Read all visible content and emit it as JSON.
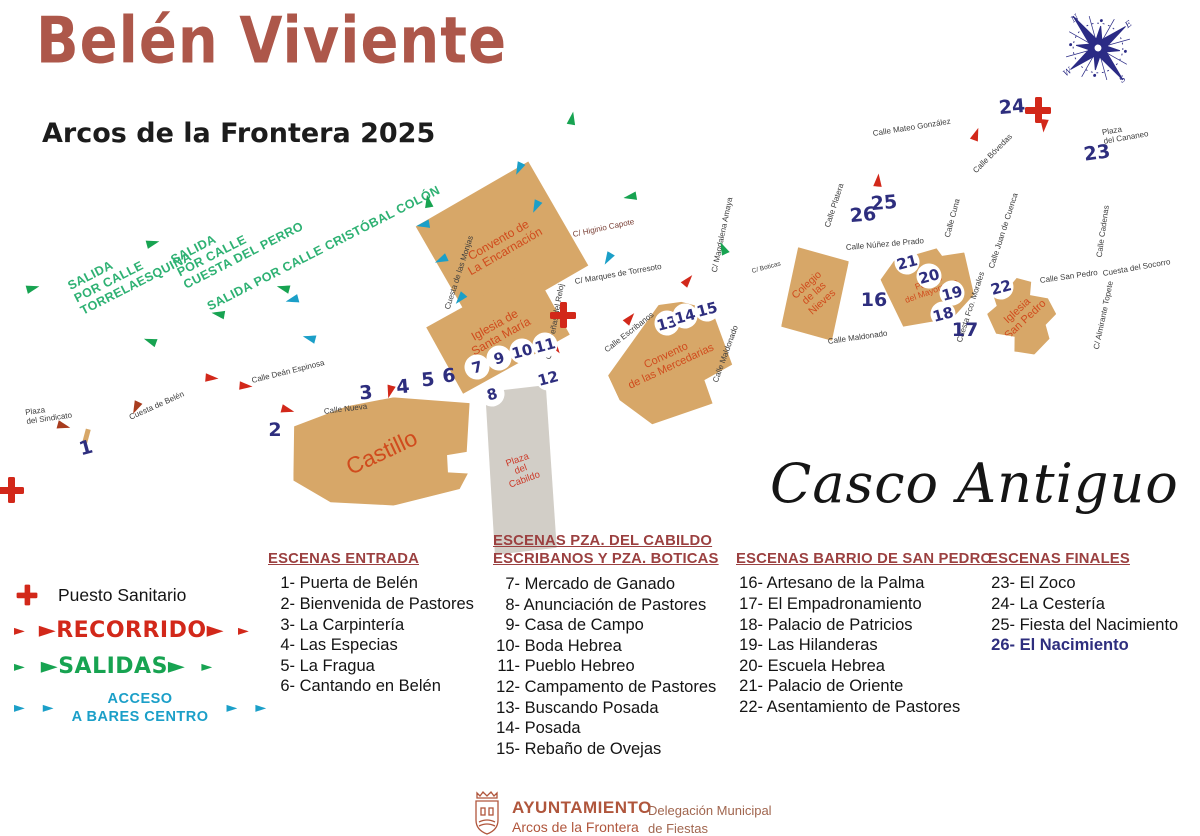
{
  "header": {
    "title": "Belén Viviente",
    "subtitle": "Arcos de la Frontera 2025"
  },
  "casco_antiguo": "Casco Antiguo",
  "compass": {
    "n": "N",
    "e": "E",
    "s": "S",
    "w": "W"
  },
  "colors": {
    "accent_red": "#d2281a",
    "dark_red": "#a83c1e",
    "green": "#17a351",
    "teal": "#1b9fc8",
    "navy": "#2e2e7e",
    "building": "#d7a768",
    "building_label": "#d04b1d",
    "plaza_gray": "#d2cec7",
    "header_maroon": "#9b4040",
    "title_brick": "#ad574a",
    "salida_green": "#2eb173",
    "footer_brick": "#b0563c"
  },
  "map": {
    "arrow_glyph": "►",
    "buildings": [
      {
        "id": "encarnacion",
        "label": [
          "Convento de",
          "La Encarnación"
        ],
        "x": 437,
        "y": 186,
        "w": 130,
        "h": 120,
        "rot": -30,
        "label_rot": 0,
        "fs": 12
      },
      {
        "id": "santa-maria",
        "label": [
          "Iglesia de",
          "Santa María"
        ],
        "x": 437,
        "y": 293,
        "w": 122,
        "h": 76,
        "rot": -29,
        "label_rot": 0,
        "fs": 12
      },
      {
        "id": "castillo",
        "label": [
          "Castillo"
        ],
        "x": 292,
        "y": 398,
        "w": 180,
        "h": 108,
        "rot": -3,
        "label_rot": -22,
        "fs": 23
      },
      {
        "id": "cabildo",
        "label": [
          "Plaza",
          "del",
          "Cabildo"
        ],
        "x": 488,
        "y": 386,
        "w": 66,
        "h": 168,
        "rot": -2,
        "label_rot": -18,
        "fs": 9.5,
        "fill": "#d2cec7",
        "lc": "#cc3b2a"
      },
      {
        "id": "mercedarias",
        "label": [
          "Convento",
          "de las Mercedarias"
        ],
        "x": 608,
        "y": 306,
        "w": 122,
        "h": 112,
        "rot": -25,
        "label_rot": 0,
        "fs": 11
      },
      {
        "id": "nieves",
        "label": [
          "Colegio",
          "de las",
          "Nieves"
        ],
        "x": 786,
        "y": 250,
        "w": 58,
        "h": 88,
        "rot": 8,
        "label_rot": -50,
        "fs": 10.5
      },
      {
        "id": "mayorazgo",
        "label": [
          "Palacio",
          "del Mayorazgo"
        ],
        "x": 886,
        "y": 250,
        "w": 88,
        "h": 74,
        "rot": -20,
        "label_rot": 0,
        "fs": 8.5
      },
      {
        "id": "san-pedro",
        "label": [
          "Iglesia",
          "San Pedro"
        ],
        "x": 988,
        "y": 276,
        "w": 68,
        "h": 80,
        "rot": -10,
        "label_rot": -33,
        "fs": 11
      },
      {
        "id": "gate",
        "label": [],
        "x": 84,
        "y": 429,
        "w": 5,
        "h": 14,
        "rot": 15
      }
    ],
    "streets": [
      {
        "t": [
          "Cuesta de las Monjas"
        ],
        "x": 448,
        "y": 305,
        "rot": -72
      },
      {
        "t": [
          "C/ Higinio Capote"
        ],
        "x": 573,
        "y": 231,
        "rot": -12,
        "c": "#7a4036"
      },
      {
        "t": [
          "C/ Marques de Torresoto"
        ],
        "x": 575,
        "y": 278,
        "rot": -10
      },
      {
        "t": [
          "Calle Deán Espinosa"
        ],
        "x": 252,
        "y": 377,
        "rot": -14
      },
      {
        "t": [
          "Cuesta de Belén"
        ],
        "x": 130,
        "y": 414,
        "rot": -24
      },
      {
        "t": [
          "Plaza",
          "del Sindicato"
        ],
        "x": 26,
        "y": 409,
        "rot": -8
      },
      {
        "t": [
          "Calle Nueva"
        ],
        "x": 324,
        "y": 408,
        "rot": -7
      },
      {
        "t": [
          "Calle Peñas del Reloj"
        ],
        "x": 549,
        "y": 355,
        "rot": -80
      },
      {
        "t": [
          "Calle Escribanos"
        ],
        "x": 606,
        "y": 347,
        "rot": -38
      },
      {
        "t": [
          "Calle Maldonado"
        ],
        "x": 716,
        "y": 378,
        "rot": -70
      },
      {
        "t": [
          "Calle Maldonado"
        ],
        "x": 828,
        "y": 338,
        "rot": -8
      },
      {
        "t": [
          "C/ Magdalena Amaya"
        ],
        "x": 715,
        "y": 268,
        "rot": -78
      },
      {
        "t": [
          "C/ Boticas"
        ],
        "x": 752,
        "y": 268,
        "rot": -15,
        "fs": 6.5
      },
      {
        "t": [
          "Calle Platera"
        ],
        "x": 828,
        "y": 223,
        "rot": -72
      },
      {
        "t": [
          "Calle Núñez de Prado"
        ],
        "x": 846,
        "y": 244,
        "rot": -5
      },
      {
        "t": [
          "Calle Cuna"
        ],
        "x": 948,
        "y": 233,
        "rot": -75
      },
      {
        "t": [
          "Calle Juan de Cuenca"
        ],
        "x": 992,
        "y": 264,
        "rot": -72
      },
      {
        "t": [
          "Calle Mateo González"
        ],
        "x": 873,
        "y": 130,
        "rot": -9
      },
      {
        "t": [
          "Calle Bóvedas"
        ],
        "x": 975,
        "y": 168,
        "rot": -45
      },
      {
        "t": [
          "Plaza",
          "del Cananeo"
        ],
        "x": 1103,
        "y": 129,
        "rot": -10
      },
      {
        "t": [
          "Calle San Pedro"
        ],
        "x": 1040,
        "y": 277,
        "rot": -8
      },
      {
        "t": [
          "Cuesta del Socorro"
        ],
        "x": 1103,
        "y": 270,
        "rot": -10
      },
      {
        "t": [
          "C/ Almirante Topete"
        ],
        "x": 1097,
        "y": 345,
        "rot": -78
      },
      {
        "t": [
          "Calle Cadenas"
        ],
        "x": 1100,
        "y": 253,
        "rot": -82
      },
      {
        "t": [
          "Cuesta Fco. Morales"
        ],
        "x": 960,
        "y": 338,
        "rot": -72
      }
    ],
    "markers": [
      {
        "n": "1",
        "x": 86,
        "y": 448,
        "rot": -15
      },
      {
        "n": "2",
        "x": 275,
        "y": 430
      },
      {
        "n": "3",
        "x": 366,
        "y": 393,
        "rot": -5
      },
      {
        "n": "4",
        "x": 403,
        "y": 387,
        "rot": -5
      },
      {
        "n": "5",
        "x": 428,
        "y": 380,
        "rot": -5
      },
      {
        "n": "6",
        "x": 449,
        "y": 376,
        "rot": -5
      },
      {
        "n": "7",
        "x": 477,
        "y": 367,
        "circ": true
      },
      {
        "n": "8",
        "x": 492,
        "y": 394,
        "circ": true
      },
      {
        "n": "9",
        "x": 499,
        "y": 358,
        "circ": true
      },
      {
        "n": "10",
        "x": 522,
        "y": 351,
        "circ": true
      },
      {
        "n": "11",
        "x": 545,
        "y": 345,
        "circ": true
      },
      {
        "n": "12",
        "x": 548,
        "y": 378,
        "circ": true
      },
      {
        "n": "13",
        "x": 667,
        "y": 323,
        "circ": true
      },
      {
        "n": "14",
        "x": 685,
        "y": 316,
        "circ": true
      },
      {
        "n": "15",
        "x": 707,
        "y": 309,
        "circ": true
      },
      {
        "n": "16",
        "x": 874,
        "y": 300
      },
      {
        "n": "17",
        "x": 965,
        "y": 330
      },
      {
        "n": "18",
        "x": 943,
        "y": 314,
        "circ": true
      },
      {
        "n": "19",
        "x": 952,
        "y": 293,
        "circ": true
      },
      {
        "n": "20",
        "x": 929,
        "y": 276,
        "circ": true
      },
      {
        "n": "21",
        "x": 907,
        "y": 262,
        "circ": true
      },
      {
        "n": "22",
        "x": 1001,
        "y": 287,
        "circ": true
      },
      {
        "n": "23",
        "x": 1097,
        "y": 153,
        "rot": -8
      },
      {
        "n": "24",
        "x": 1012,
        "y": 107,
        "rot": -5
      },
      {
        "n": "25",
        "x": 884,
        "y": 203,
        "rot": -5
      },
      {
        "n": "26",
        "x": 863,
        "y": 215,
        "rot": -5
      }
    ],
    "arrows": [
      {
        "x": 212,
        "y": 378,
        "rot": 5,
        "c": "accent_red"
      },
      {
        "x": 246,
        "y": 386,
        "rot": 5,
        "c": "accent_red"
      },
      {
        "x": 136,
        "y": 408,
        "rot": 115,
        "c": "dark_red"
      },
      {
        "x": 288,
        "y": 410,
        "rot": 15,
        "c": "accent_red"
      },
      {
        "x": 64,
        "y": 426,
        "rot": 15,
        "c": "dark_red"
      },
      {
        "x": 390,
        "y": 392,
        "rot": 105,
        "c": "accent_red"
      },
      {
        "x": 556,
        "y": 348,
        "rot": 55,
        "c": "accent_red"
      },
      {
        "x": 630,
        "y": 318,
        "rot": -50,
        "c": "accent_red"
      },
      {
        "x": 688,
        "y": 280,
        "rot": -50,
        "c": "accent_red"
      },
      {
        "x": 878,
        "y": 180,
        "rot": -85,
        "c": "accent_red"
      },
      {
        "x": 976,
        "y": 134,
        "rot": -70,
        "c": "accent_red"
      },
      {
        "x": 1044,
        "y": 126,
        "rot": 95,
        "c": "accent_red"
      },
      {
        "x": 33,
        "y": 288,
        "rot": -15,
        "c": "green"
      },
      {
        "x": 153,
        "y": 243,
        "rot": -15,
        "c": "green"
      },
      {
        "x": 572,
        "y": 118,
        "rot": -80,
        "c": "green"
      },
      {
        "x": 428,
        "y": 201,
        "rot": -100,
        "c": "green"
      },
      {
        "x": 630,
        "y": 197,
        "rot": 170,
        "c": "green"
      },
      {
        "x": 283,
        "y": 288,
        "rot": 195,
        "c": "green"
      },
      {
        "x": 218,
        "y": 314,
        "rot": 190,
        "c": "green"
      },
      {
        "x": 150,
        "y": 341,
        "rot": 200,
        "c": "green"
      },
      {
        "x": 723,
        "y": 248,
        "rot": -115,
        "c": "green"
      },
      {
        "x": 519,
        "y": 169,
        "rot": 115,
        "c": "teal"
      },
      {
        "x": 423,
        "y": 225,
        "rot": 170,
        "c": "teal"
      },
      {
        "x": 441,
        "y": 260,
        "rot": 155,
        "c": "teal"
      },
      {
        "x": 536,
        "y": 207,
        "rot": 115,
        "c": "teal"
      },
      {
        "x": 608,
        "y": 259,
        "rot": 120,
        "c": "teal"
      },
      {
        "x": 460,
        "y": 299,
        "rot": 130,
        "c": "teal"
      },
      {
        "x": 309,
        "y": 338,
        "rot": 195,
        "c": "teal"
      },
      {
        "x": 292,
        "y": 300,
        "rot": 165,
        "c": "teal"
      }
    ],
    "crosses": [
      {
        "x": 563,
        "y": 315
      },
      {
        "x": 1038,
        "y": 110
      },
      {
        "x": 11,
        "y": 490
      }
    ],
    "salidas": [
      {
        "t": [
          "SALIDA",
          "POR CALLE",
          "TORRELAESQUINA"
        ],
        "x": 75,
        "y": 278,
        "rot": -27
      },
      {
        "t": [
          "SALIDA",
          "POR CALLE",
          "CUESTA DEL PERRO"
        ],
        "x": 178,
        "y": 252,
        "rot": -27
      },
      {
        "t": [
          "SALIDA POR CALLE CRISTÓBAL COLÓN"
        ],
        "x": 208,
        "y": 300,
        "rot": -27
      }
    ]
  },
  "legend": {
    "arrow": "►",
    "sanitario": "Puesto Sanitario",
    "recorrido": "RECORRIDO",
    "salidas": "SALIDAS",
    "acceso": [
      "ACCESO",
      "A BARES CENTRO"
    ]
  },
  "scene_lists": [
    {
      "id": "entrada",
      "x": 268,
      "y": 550,
      "header": [
        "ESCENAS ENTRADA"
      ],
      "items": [
        {
          "n": "1",
          "t": "Puerta de Belén"
        },
        {
          "n": "2",
          "t": "Bienvenida de Pastores"
        },
        {
          "n": "3",
          "t": "La Carpintería"
        },
        {
          "n": "4",
          "t": "Las Especias"
        },
        {
          "n": "5",
          "t": "La Fragua"
        },
        {
          "n": "6",
          "t": "Cantando en Belén"
        }
      ]
    },
    {
      "id": "cabildo-boticas",
      "x": 493,
      "y": 532,
      "header": [
        "ESCENAS PZA. DEL CABILDO",
        "ESCRIBANOS Y PZA. BOTICAS"
      ],
      "items": [
        {
          "n": "7",
          "t": "Mercado de Ganado"
        },
        {
          "n": "8",
          "t": "Anunciación de Pastores"
        },
        {
          "n": "9",
          "t": "Casa de Campo"
        },
        {
          "n": "10",
          "t": "Boda Hebrea"
        },
        {
          "n": "11",
          "t": "Pueblo Hebreo"
        },
        {
          "n": "12",
          "t": "Campamento de Pastores"
        },
        {
          "n": "13",
          "t": "Buscando Posada"
        },
        {
          "n": "14",
          "t": "Posada"
        },
        {
          "n": "15",
          "t": "Rebaño de Ovejas"
        }
      ]
    },
    {
      "id": "barrio-san-pedro",
      "x": 736,
      "y": 550,
      "header": [
        "ESCENAS BARRIO DE SAN PEDRO"
      ],
      "items": [
        {
          "n": "16",
          "t": "Artesano de la Palma"
        },
        {
          "n": "17",
          "t": "El Empadronamiento"
        },
        {
          "n": "18",
          "t": "Palacio de Patricios"
        },
        {
          "n": "19",
          "t": "Las Hilanderas"
        },
        {
          "n": "20",
          "t": "Escuela Hebrea"
        },
        {
          "n": "21",
          "t": "Palacio de Oriente"
        },
        {
          "n": "22",
          "t": "Asentamiento de Pastores"
        }
      ]
    },
    {
      "id": "finales",
      "x": 988,
      "y": 550,
      "header": [
        "ESCENAS FINALES"
      ],
      "items": [
        {
          "n": "23",
          "t": "El Zoco"
        },
        {
          "n": "24",
          "t": "La Cestería"
        },
        {
          "n": "25",
          "t": "Fiesta del Nacimiento"
        },
        {
          "n": "26",
          "t": "El Nacimiento",
          "hl": true
        }
      ]
    }
  ],
  "footer": {
    "org": "AYUNTAMIENTO",
    "org_sub": "Arcos de la Frontera",
    "dept": [
      "Delegación Municipal",
      "de Fiestas"
    ]
  }
}
